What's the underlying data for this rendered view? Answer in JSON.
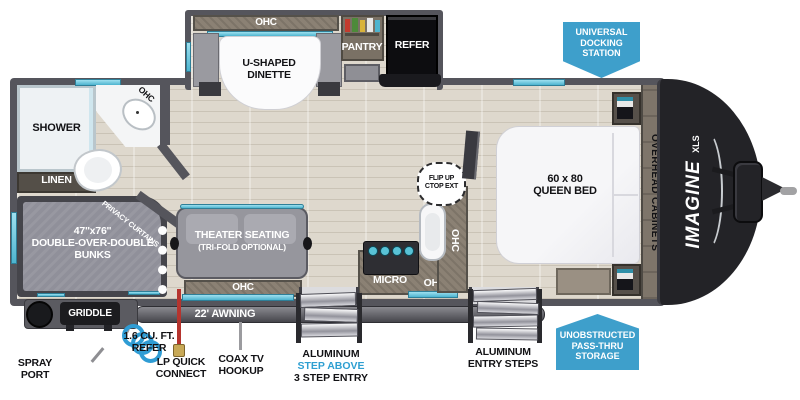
{
  "colors": {
    "accent_blue": "#3E9FCB",
    "step_above_blue": "#2E9FD1",
    "wall_gray": "#55555C",
    "floor_beige": "#DED8CD",
    "front_cap_black": "#232327",
    "window_teal": "#4DB4CF"
  },
  "logo": {
    "name": "IMAGINE",
    "sub": "XLS"
  },
  "badges": {
    "docking": "UNIVERSAL\nDOCKING\nSTATION",
    "passthru": "UNOBSTRUCTED\nPASS-THRU\nSTORAGE"
  },
  "rooms": {
    "ohc": "OHC",
    "dinette": "U-SHAPED\nDINETTE",
    "pantry": "PANTRY",
    "refer": "REFER",
    "shower": "SHOWER",
    "linen": "LINEN",
    "bunks": "47''x76''\nDOUBLE-OVER-DOUBLE\nBUNKS",
    "privacy_curtains": "PRIVACY CURTAINS",
    "theater": "THEATER SEATING",
    "theater_sub": "(TRI-FOLD OPTIONAL)",
    "micro": "MICRO",
    "flip_up": "FLIP UP\nCTOP EXT",
    "queen_bed": "60 x 80\nQUEEN BED",
    "overhead_cabinets": "OVERHEAD CABINETS"
  },
  "exterior": {
    "griddle": "GRIDDLE",
    "awning": "22' AWNING",
    "spray_port": "SPRAY\nPORT",
    "mini_refer": "1.6 CU. FT.\nREFER",
    "lp_connect": "LP QUICK\nCONNECT",
    "coax": "COAX TV\nHOOKUP",
    "step_above_1": "ALUMINUM",
    "step_above_2": "STEP ABOVE",
    "step_above_3": "3 STEP ENTRY",
    "entry_steps": "ALUMINUM\nENTRY STEPS"
  }
}
